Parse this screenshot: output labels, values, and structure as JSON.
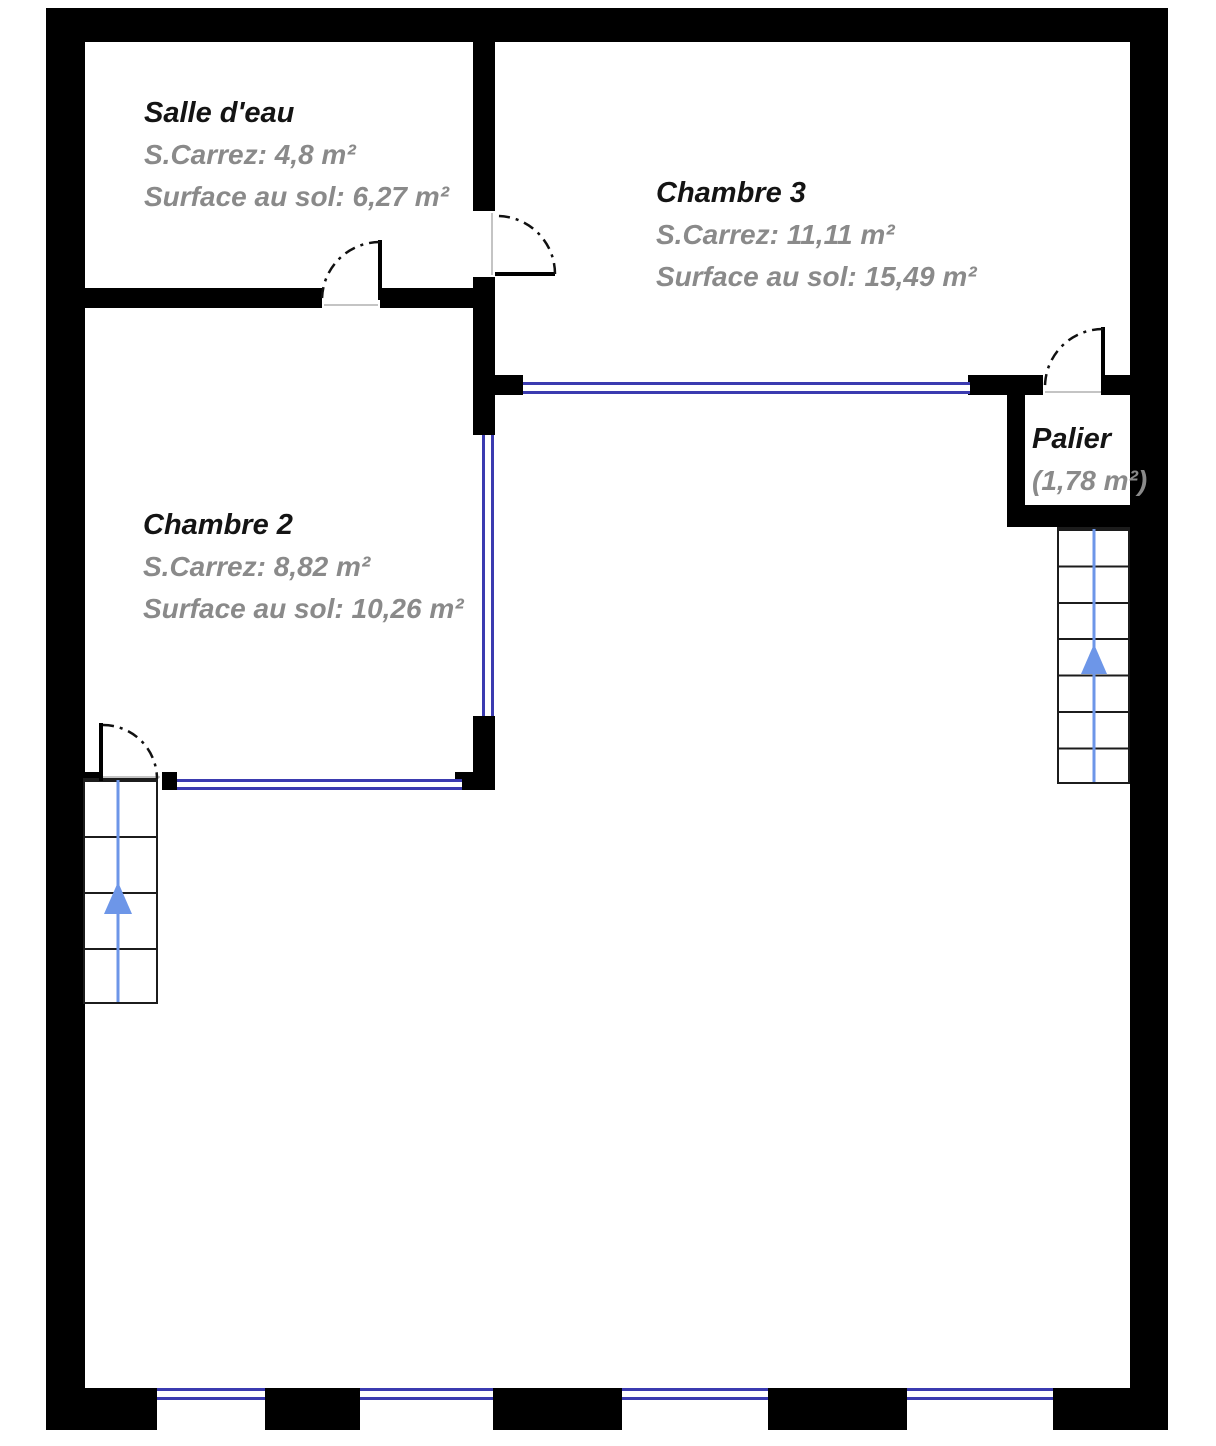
{
  "plan": {
    "type": "floor-plan",
    "rooms": [
      {
        "id": "salle-deau",
        "name": "Salle d'eau",
        "carrez": "S.Carrez: 4,8 m²",
        "floor": "Surface au sol: 6,27 m²"
      },
      {
        "id": "chambre3",
        "name": "Chambre 3",
        "carrez": "S.Carrez: 11,11 m²",
        "floor": "Surface au sol: 15,49 m²"
      },
      {
        "id": "chambre2",
        "name": "Chambre 2",
        "carrez": "S.Carrez: 8,82 m²",
        "floor": "Surface au sol: 10,26 m²"
      },
      {
        "id": "palier",
        "name": "Palier",
        "area": "(1,78 m²)"
      }
    ],
    "stairs": [
      {
        "id": "stairs-left",
        "direction": "up",
        "icon": "stairs-up-arrow-icon"
      },
      {
        "id": "stairs-right",
        "direction": "up",
        "icon": "stairs-up-arrow-icon"
      }
    ],
    "colors": {
      "wall": "#000000",
      "window": "#3b3bb0",
      "stair_arrow": "#6d96e8",
      "room_title_text": "#141414",
      "room_value_text": "#8a8a8a",
      "background": "#ffffff"
    }
  }
}
